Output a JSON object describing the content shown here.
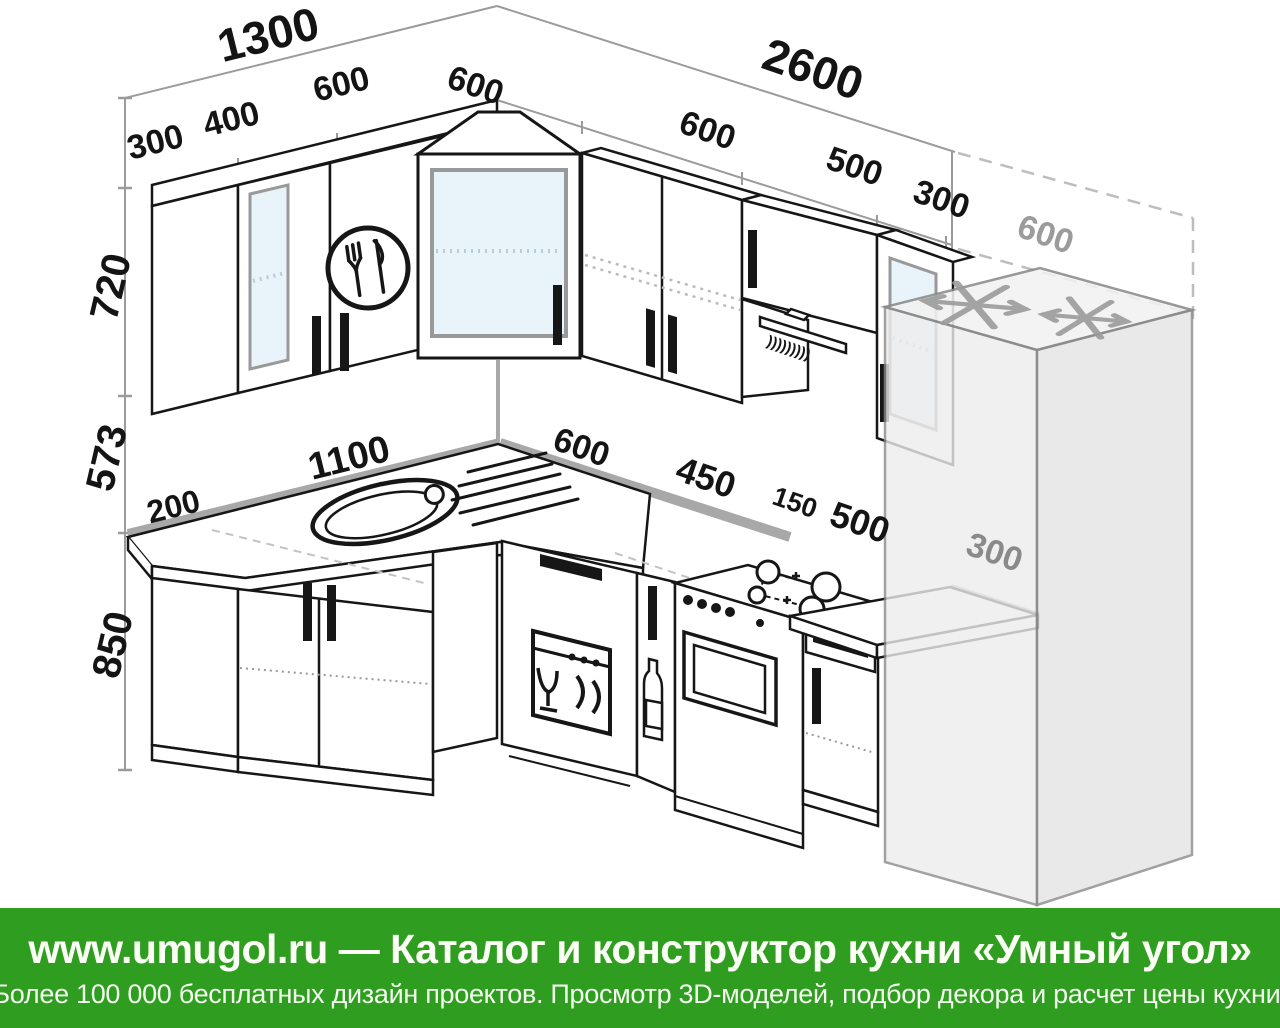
{
  "page": {
    "background": "#ffffff",
    "type": "kitchen-layout-diagram"
  },
  "colors": {
    "banner_green": "#2f9e20",
    "line_black": "#161616",
    "dim_gray": "#9b9b9b",
    "wall_strip_gray": "#a8a8a8",
    "glass_blue": "#e9f3fa",
    "fridge_gray": "#ededed"
  },
  "dims": {
    "total_left": "1300",
    "total_right": "2600",
    "upper_left_1": "300",
    "upper_left_2": "400",
    "upper_left_3": "600",
    "upper_right_1": "600",
    "upper_right_2": "600",
    "upper_right_3": "500",
    "upper_right_4": "300",
    "upper_right_5": "600",
    "height_upper": "720",
    "height_apron": "573",
    "height_base": "850",
    "base_left_1": "200",
    "base_left_2": "1100",
    "base_right_1": "600",
    "base_right_2": "450",
    "base_right_3": "150",
    "base_right_4": "500",
    "base_right_5": "300"
  },
  "icons": {
    "hood_vents": ")))))))))",
    "logo": "fork-and-knife-circle",
    "fridge_mark": "snowflake",
    "dishwasher_mark": "glass-and-plates",
    "cargo_mark": "bottle"
  },
  "footer": {
    "line1": "www.umugol.ru — Каталог и конструктор кухни «Умный угол»",
    "line2": "Более 100 000 бесплатных дизайн проектов. Просмотр 3D-моделей, подбор декора и расчет цены кухни."
  }
}
